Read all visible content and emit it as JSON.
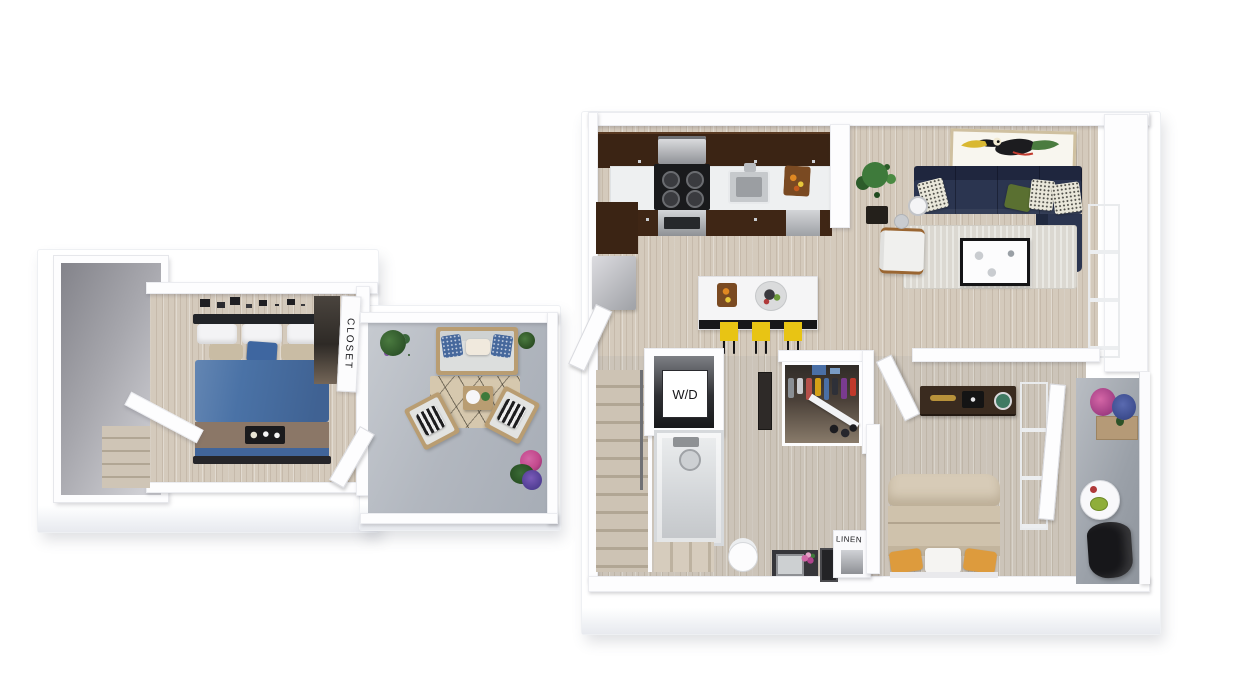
{
  "floorplan": {
    "labels": {
      "washer_dryer": "W/D",
      "closet": "CLOSET",
      "linen": "LINEN"
    },
    "colors": {
      "page_bg": "#ffffff",
      "wall": "#fdfdfe",
      "wood_floor": "#d4cabc",
      "balcony_floor": "#b4b9c0",
      "void_gray": "#98989d",
      "cabinet_brown": "#3b2414",
      "counter": "#eef0f1",
      "island_top": "#f5f5f6",
      "island_base": "#17171a",
      "stool_yellow": "#e8c414",
      "sofa_navy": "#2b3550",
      "pillow_green": "#5a7031",
      "bed_blue": "#4a72a6",
      "bed_blanket_brown": "#8b7767",
      "bed_beige": "#d7cbb7",
      "pillow_orange": "#dd9b3d",
      "rug_living": "#dbd8d1",
      "rug_outdoor": "#d6c8ae",
      "stair_wood": "#cfc5b6",
      "stair_edge": "#b1a694",
      "plant_green": "#3e7a3b",
      "flower_pink": "#c2498c",
      "flower_blue": "#3c4c8e",
      "chair_black": "#17171a",
      "wood_frame": "#b99d72",
      "glass_gray": "#a9adb3",
      "dresser_brown": "#3a2b1f",
      "art_frame_tan": "#cfc0a0"
    }
  }
}
